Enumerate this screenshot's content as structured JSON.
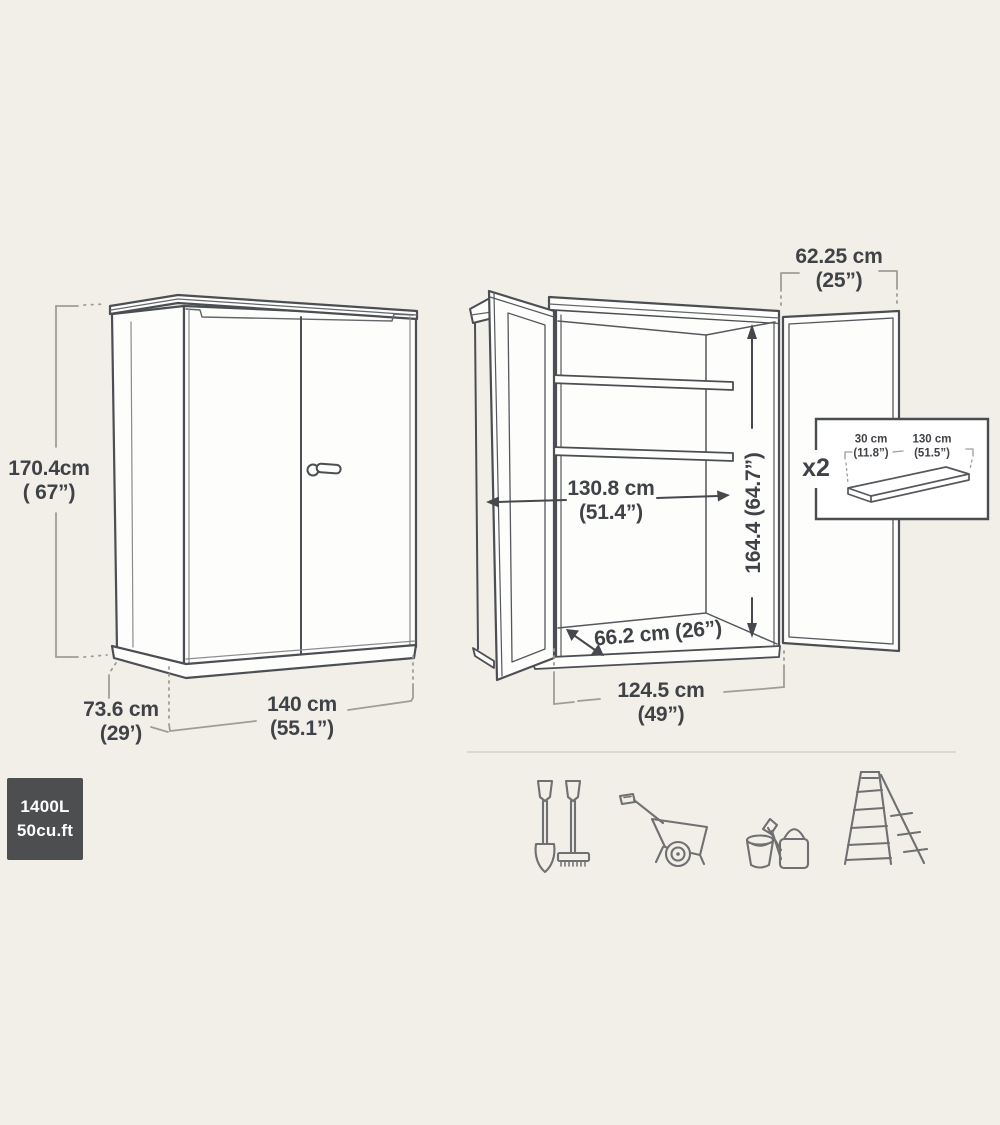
{
  "page": {
    "background_color": "#f2efe9",
    "line_color": "#4b4e52",
    "dimension_line_color": "#a09c96",
    "text_color": "#3f4246",
    "icon_color": "#6f7072"
  },
  "closed_cabinet": {
    "description": "closed storage cabinet exterior dimensions",
    "height": {
      "metric": "170.4cm",
      "imperial": "( 67”)"
    },
    "depth": {
      "metric": "73.6 cm",
      "imperial": "(29’)"
    },
    "width": {
      "metric": "140 cm",
      "imperial": "(55.1”)"
    }
  },
  "open_cabinet": {
    "description": "open storage cabinet interior dimensions",
    "door_width": {
      "metric": "62.25 cm",
      "imperial": "(25”)"
    },
    "interior_width": {
      "metric": "130.8 cm",
      "imperial": "(51.4”)"
    },
    "interior_height": {
      "combined": "164.4 (64.7”)"
    },
    "floor_depth": {
      "combined": "66.2 cm (26”)"
    },
    "opening_width": {
      "metric": "124.5 cm",
      "imperial": "(49”)"
    }
  },
  "shelf_inset": {
    "quantity": "x2",
    "shelf_depth": {
      "metric": "30 cm",
      "imperial": "(11.8”)"
    },
    "shelf_width": {
      "metric": "130 cm",
      "imperial": "(51.5”)"
    }
  },
  "capacity_badge": {
    "liters": "1400L",
    "cubic_feet": "50cu.ft",
    "background": "#4d4e50"
  },
  "storage_icons": [
    {
      "name": "shovel-and-rake-icon"
    },
    {
      "name": "wheelbarrow-icon"
    },
    {
      "name": "bucket-and-watering-can-icon"
    },
    {
      "name": "ladder-icon"
    }
  ]
}
